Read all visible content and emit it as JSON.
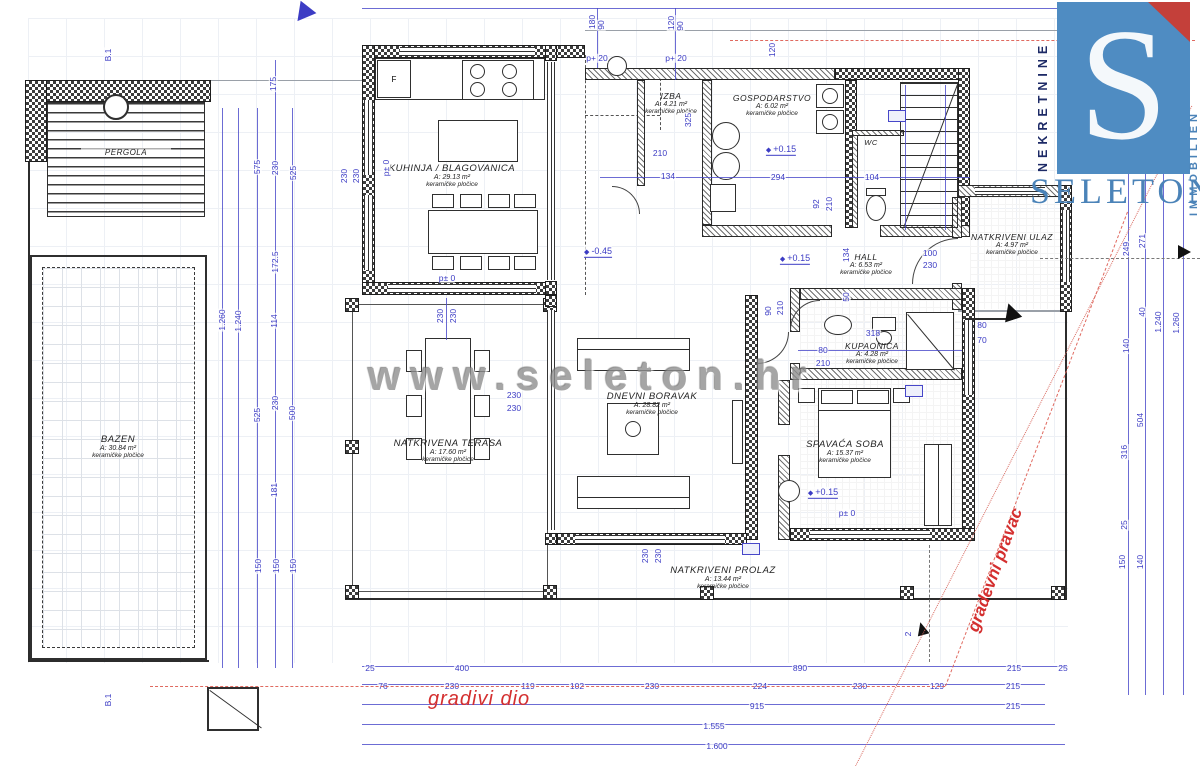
{
  "watermark": {
    "text": "www.seleton.hr",
    "color": "#8f8f8f"
  },
  "logo": {
    "letter": "S",
    "word": "SELETON",
    "left_vertical": "NEKRETNINE",
    "right_vertical": "IMMOBILIEN",
    "square_color": "#4f8cc2",
    "word_color": "#4b83b8",
    "triangle_color": "#c4403a"
  },
  "red_annotations": {
    "gradivi_dio": "gradivi dio",
    "gradevni_pravac": "gradevni pravac",
    "color": "#d42f2f"
  },
  "labels": {
    "wc": "WC",
    "fridge": "F"
  },
  "rooms": [
    {
      "name": "KUHINJA / BLAGOVANICA",
      "area": "A: 29.13 m²",
      "floor": "keramičke pločice"
    },
    {
      "name": "IZBA",
      "area": "A: 4.21 m²",
      "floor": "keramičke pločice"
    },
    {
      "name": "GOSPODARSTVO",
      "area": "A: 6.02 m²",
      "floor": "keramičke pločice"
    },
    {
      "name": "HALL",
      "area": "A: 6.53 m²",
      "floor": "keramičke pločice"
    },
    {
      "name": "NATKRIVENI ULAZ",
      "area": "A: 4.97 m²",
      "floor": "keramičke pločice"
    },
    {
      "name": "KUPAONICA",
      "area": "A: 4.28 m²",
      "floor": "keramičke pločice"
    },
    {
      "name": "DNEVNI BORAVAK",
      "area": "A: 28.82 m²",
      "floor": "keramičke pločice"
    },
    {
      "name": "SPAVAĆA SOBA",
      "area": "A: 15.37 m²",
      "floor": "keramičke pločice"
    },
    {
      "name": "NATKRIVENA TERASA",
      "area": "A: 17.60 m²",
      "floor": "keramičke pločice"
    },
    {
      "name": "NATKRIVENI PROLAZ",
      "area": "A: 13.44 m²",
      "floor": "keramičke pločice"
    },
    {
      "name": "BAZEN",
      "area": "A: 30.84 m²",
      "floor": "keramičke pločice"
    },
    {
      "name": "PERGOLA",
      "area": "",
      "floor": ""
    }
  ],
  "elevations": [
    {
      "x": 781,
      "y": 150,
      "t": "+0.15"
    },
    {
      "x": 795,
      "y": 259,
      "t": "+0.15"
    },
    {
      "x": 598,
      "y": 252,
      "t": "-0.45"
    },
    {
      "x": 823,
      "y": 493,
      "t": "+0.15"
    }
  ],
  "level_labels": [
    {
      "x": 386,
      "y": 168,
      "t": "p± 0",
      "r": 1
    },
    {
      "x": 447,
      "y": 278,
      "t": "p± 0"
    },
    {
      "x": 847,
      "y": 513,
      "t": "p± 0"
    },
    {
      "x": 597,
      "y": 58,
      "t": "p+ 20"
    },
    {
      "x": 676,
      "y": 58,
      "t": "p+ 20"
    }
  ],
  "dims": [
    {
      "x": 592,
      "y": 22,
      "t": "180",
      "r": 1
    },
    {
      "x": 601,
      "y": 25,
      "t": "90",
      "r": 1
    },
    {
      "x": 671,
      "y": 23,
      "t": "120",
      "r": 1
    },
    {
      "x": 680,
      "y": 26,
      "t": "90",
      "r": 1
    },
    {
      "x": 772,
      "y": 50,
      "t": "120",
      "r": 1
    },
    {
      "x": 1124,
      "y": 48,
      "t": "60",
      "r": 1
    },
    {
      "x": 1140,
      "y": 51,
      "t": "60",
      "r": 1
    },
    {
      "x": 1127,
      "y": 132,
      "t": "240",
      "r": 1
    },
    {
      "x": 1143,
      "y": 130,
      "t": "155",
      "r": 1
    },
    {
      "x": 1126,
      "y": 249,
      "t": "249",
      "r": 1
    },
    {
      "x": 1142,
      "y": 241,
      "t": "271",
      "r": 1
    },
    {
      "x": 1126,
      "y": 346,
      "t": "140",
      "r": 1
    },
    {
      "x": 1142,
      "y": 312,
      "t": "40",
      "r": 1
    },
    {
      "x": 1158,
      "y": 322,
      "t": "1.240",
      "r": 1
    },
    {
      "x": 1176,
      "y": 323,
      "t": "1.260",
      "r": 1
    },
    {
      "x": 1140,
      "y": 420,
      "t": "504",
      "r": 1
    },
    {
      "x": 1124,
      "y": 452,
      "t": "316",
      "r": 1
    },
    {
      "x": 1124,
      "y": 525,
      "t": "25",
      "r": 1
    },
    {
      "x": 1122,
      "y": 562,
      "t": "150",
      "r": 1
    },
    {
      "x": 1140,
      "y": 562,
      "t": "140",
      "r": 1
    },
    {
      "x": 222,
      "y": 320,
      "t": "1.260",
      "r": 1
    },
    {
      "x": 238,
      "y": 321,
      "t": "1.240",
      "r": 1
    },
    {
      "x": 257,
      "y": 167,
      "t": "575",
      "r": 1
    },
    {
      "x": 257,
      "y": 415,
      "t": "525",
      "r": 1
    },
    {
      "x": 258,
      "y": 566,
      "t": "150",
      "r": 1
    },
    {
      "x": 273,
      "y": 84,
      "t": "175",
      "r": 1
    },
    {
      "x": 275,
      "y": 168,
      "t": "230",
      "r": 1
    },
    {
      "x": 275,
      "y": 262,
      "t": "172.5",
      "r": 1
    },
    {
      "x": 274,
      "y": 321,
      "t": "114",
      "r": 1
    },
    {
      "x": 275,
      "y": 403,
      "t": "230",
      "r": 1
    },
    {
      "x": 274,
      "y": 490,
      "t": "181",
      "r": 1
    },
    {
      "x": 276,
      "y": 566,
      "t": "150",
      "r": 1
    },
    {
      "x": 293,
      "y": 173,
      "t": "525",
      "r": 1
    },
    {
      "x": 292,
      "y": 413,
      "t": "500",
      "r": 1
    },
    {
      "x": 293,
      "y": 566,
      "t": "150",
      "r": 1
    },
    {
      "x": 660,
      "y": 153,
      "t": "210"
    },
    {
      "x": 668,
      "y": 176,
      "t": "134"
    },
    {
      "x": 778,
      "y": 177,
      "t": "294"
    },
    {
      "x": 872,
      "y": 177,
      "t": "104"
    },
    {
      "x": 816,
      "y": 204,
      "t": "92",
      "r": 1
    },
    {
      "x": 829,
      "y": 204,
      "t": "210",
      "r": 1
    },
    {
      "x": 688,
      "y": 120,
      "t": "325",
      "r": 1
    },
    {
      "x": 930,
      "y": 253,
      "t": "100"
    },
    {
      "x": 930,
      "y": 265,
      "t": "230"
    },
    {
      "x": 846,
      "y": 255,
      "t": "134",
      "r": 1
    },
    {
      "x": 846,
      "y": 297,
      "t": "50",
      "r": 1
    },
    {
      "x": 873,
      "y": 333,
      "t": "318"
    },
    {
      "x": 823,
      "y": 350,
      "t": "80"
    },
    {
      "x": 823,
      "y": 363,
      "t": "210"
    },
    {
      "x": 768,
      "y": 311,
      "t": "90",
      "r": 1
    },
    {
      "x": 780,
      "y": 308,
      "t": "210",
      "r": 1
    },
    {
      "x": 982,
      "y": 325,
      "t": "80"
    },
    {
      "x": 982,
      "y": 340,
      "t": "70"
    },
    {
      "x": 514,
      "y": 395,
      "t": "230"
    },
    {
      "x": 514,
      "y": 408,
      "t": "230"
    },
    {
      "x": 440,
      "y": 316,
      "t": "230",
      "r": 1
    },
    {
      "x": 453,
      "y": 316,
      "t": "230",
      "r": 1
    },
    {
      "x": 344,
      "y": 176,
      "t": "230",
      "r": 1
    },
    {
      "x": 356,
      "y": 176,
      "t": "230",
      "r": 1
    },
    {
      "x": 645,
      "y": 556,
      "t": "230",
      "r": 1
    },
    {
      "x": 658,
      "y": 556,
      "t": "230",
      "r": 1
    },
    {
      "x": 370,
      "y": 668,
      "t": "25"
    },
    {
      "x": 462,
      "y": 668,
      "t": "400"
    },
    {
      "x": 800,
      "y": 668,
      "t": "890"
    },
    {
      "x": 1014,
      "y": 668,
      "t": "215"
    },
    {
      "x": 1063,
      "y": 668,
      "t": "25"
    },
    {
      "x": 383,
      "y": 686,
      "t": "76"
    },
    {
      "x": 452,
      "y": 686,
      "t": "230"
    },
    {
      "x": 528,
      "y": 686,
      "t": "119"
    },
    {
      "x": 577,
      "y": 686,
      "t": "102"
    },
    {
      "x": 652,
      "y": 686,
      "t": "230"
    },
    {
      "x": 760,
      "y": 686,
      "t": "224"
    },
    {
      "x": 860,
      "y": 686,
      "t": "230"
    },
    {
      "x": 937,
      "y": 686,
      "t": "129"
    },
    {
      "x": 1013,
      "y": 686,
      "t": "215"
    },
    {
      "x": 757,
      "y": 706,
      "t": "915"
    },
    {
      "x": 1013,
      "y": 706,
      "t": "215"
    },
    {
      "x": 714,
      "y": 726,
      "t": "1.555"
    },
    {
      "x": 717,
      "y": 746,
      "t": "1.600"
    },
    {
      "x": 908,
      "y": 634,
      "t": "2",
      "r": 1
    },
    {
      "x": 108,
      "y": 55,
      "t": "B.1",
      "r": 1
    },
    {
      "x": 108,
      "y": 700,
      "t": "B.1",
      "r": 1
    }
  ]
}
